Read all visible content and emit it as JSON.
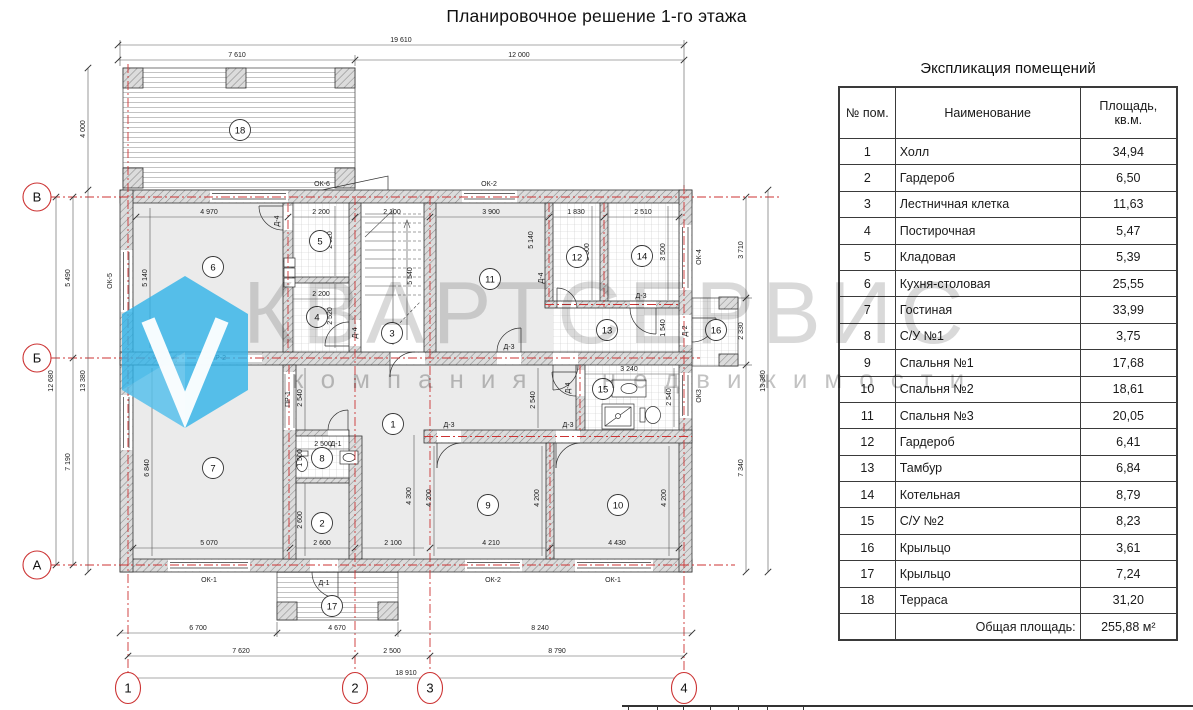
{
  "title": "Планировочное решение 1-го этажа",
  "watermark": {
    "brand": "КВАРТСЕРВИС",
    "tagline": "компания недвижимости",
    "logo_color": "#2fb3e8",
    "text_color": "#d6d6d6"
  },
  "plan": {
    "axis_color": "#cc3333",
    "axes": {
      "rows": [
        "В",
        "Б",
        "А"
      ],
      "cols": [
        "1",
        "2",
        "3",
        "4"
      ]
    },
    "dims": {
      "t_total": "19 610",
      "t_l": "7 610",
      "t_r": "12 000",
      "b1_l": "6 700",
      "b1_m": "4 670",
      "b1_r": "8 240",
      "b2_l": "7 620",
      "b2_m": "2 500",
      "b2_r": "8 790",
      "b3": "18 910",
      "l_terr": "4 000",
      "l_vb": "5 490",
      "l_ba": "7 190",
      "l_va": "12 680",
      "side_tot": "13 380",
      "r_top": "3 710",
      "r_porch": "2 330",
      "r_bot": "7 340",
      "w6": "4 970",
      "h6": "5 140",
      "w5": "2 200",
      "h5": "2 620",
      "h4": "2 520",
      "wst": "2 100",
      "hst": "5 540",
      "w11": "3 900",
      "w12": "1 830",
      "w14": "2 510",
      "h12": "3 500",
      "h13": "1 540",
      "w15": "3 240",
      "c2540": "2 540",
      "w8": "2 500",
      "h8": "1 500",
      "w7": "5 070",
      "h7": "6 840",
      "w2": "2 600",
      "hhall": "4 300",
      "w9": "4 210",
      "w10": "4 430",
      "h9": "4 200"
    },
    "labels": {
      "ok1": "ОК-1",
      "ok2": "ОК-2",
      "ok3": "ОК3",
      "ok4": "ОК-4",
      "ok5": "ОК-5",
      "ok6": "ОК-6",
      "d1": "Д-1",
      "d2": "Д-2",
      "d3": "Д-3",
      "d4": "Д-4",
      "pr1": "ПР-1",
      "pr2": "ПР-2"
    }
  },
  "table": {
    "title": "Экспликация помещений",
    "headers": {
      "num": "№ пом.",
      "name": "Наименование",
      "area": "Площадь, кв.м."
    },
    "rows": [
      {
        "num": "1",
        "name": "Холл",
        "area": "34,94"
      },
      {
        "num": "2",
        "name": "Гардероб",
        "area": "6,50"
      },
      {
        "num": "3",
        "name": "Лестничная клетка",
        "area": "11,63"
      },
      {
        "num": "4",
        "name": "Постирочная",
        "area": "5,47"
      },
      {
        "num": "5",
        "name": "Кладовая",
        "area": "5,39"
      },
      {
        "num": "6",
        "name": "Кухня-столовая",
        "area": "25,55"
      },
      {
        "num": "7",
        "name": "Гостиная",
        "area": "33,99"
      },
      {
        "num": "8",
        "name": "С/У №1",
        "area": "3,75"
      },
      {
        "num": "9",
        "name": "Спальня №1",
        "area": "17,68"
      },
      {
        "num": "10",
        "name": "Спальня №2",
        "area": "18,61"
      },
      {
        "num": "11",
        "name": "Спальня №3",
        "area": "20,05"
      },
      {
        "num": "12",
        "name": "Гардероб",
        "area": "6,41"
      },
      {
        "num": "13",
        "name": "Тамбур",
        "area": "6,84"
      },
      {
        "num": "14",
        "name": "Котельная",
        "area": "8,79"
      },
      {
        "num": "15",
        "name": "С/У №2",
        "area": "8,23"
      },
      {
        "num": "16",
        "name": "Крыльцо",
        "area": "3,61"
      },
      {
        "num": "17",
        "name": "Крыльцо",
        "area": "7,24"
      },
      {
        "num": "18",
        "name": "Терраса",
        "area": "31,20"
      }
    ],
    "total_label": "Общая площадь:",
    "total_value": "255,88 м²"
  }
}
